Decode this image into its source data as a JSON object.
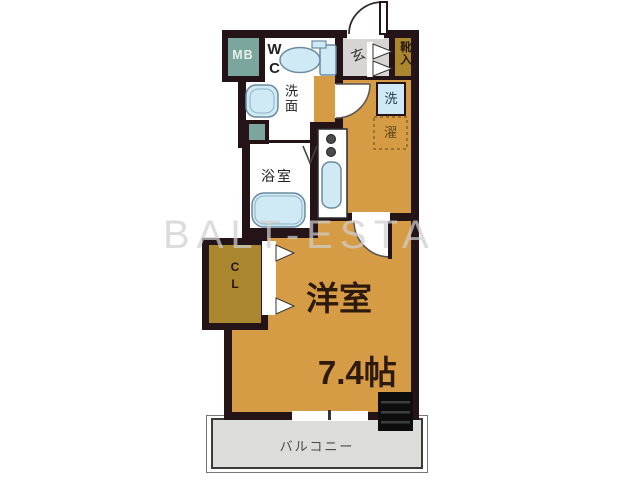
{
  "watermark": "BALT-ESTA",
  "labels": {
    "meter_box": "MB",
    "toilet": "WC",
    "washstand": "洗面",
    "bathroom": "浴室",
    "entrance": "玄",
    "shoe_cabinet": "靴入",
    "laundry_char_1": "洗",
    "laundry_char_2": "濯",
    "closet": "CL",
    "main_room_name": "洋室",
    "main_room_size": "7.4帖",
    "balcony": "バルコニー"
  },
  "colors": {
    "wall": "#241417",
    "room-orange": "#d69c45",
    "mustard": "#aa872f",
    "teal": "#7aa69e",
    "fixture-blue": "#cfeaf4",
    "fixture-border": "#6b8aa0",
    "entrance-gray": "#d6d5d3",
    "balcony-gray": "#dcdcda",
    "text-dark": "#241417"
  }
}
